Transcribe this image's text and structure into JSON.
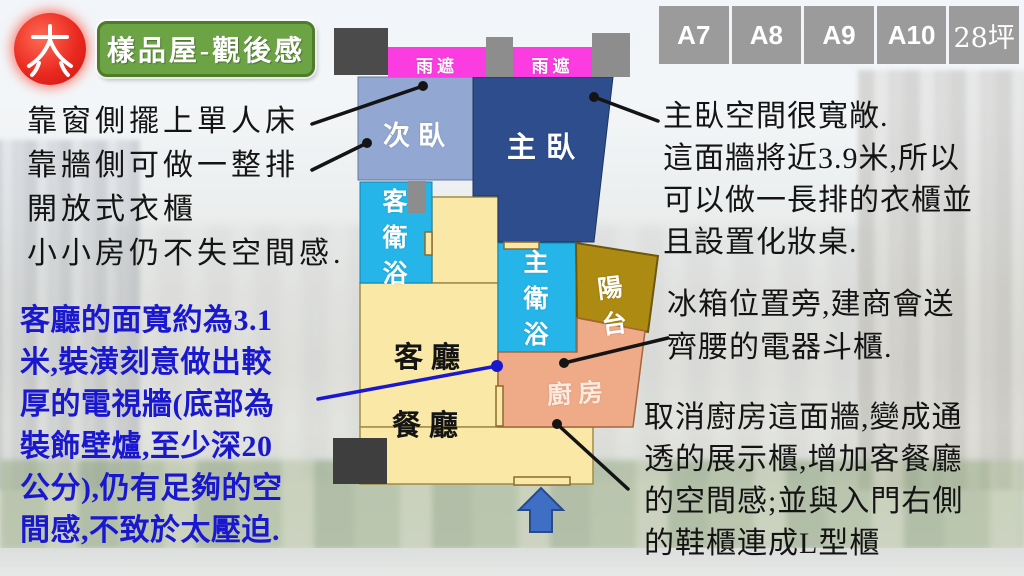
{
  "title_badge": {
    "text": "樣品屋-觀後感"
  },
  "unit_tabs": [
    "A7",
    "A8",
    "A9",
    "A10",
    "28坪"
  ],
  "floor_plan": {
    "labels": {
      "rain_cover_left": "雨遮",
      "rain_cover_right": "雨遮",
      "secondary_bedroom": "次臥",
      "master_bedroom": "主臥",
      "guest_bathroom": "客衛浴",
      "master_bathroom": "主衛浴",
      "balcony": "陽台",
      "kitchen": "廚房",
      "living_room": "客廳",
      "dining_room": "餐廳"
    },
    "entrance_arrow_direction": "up"
  },
  "annotations": {
    "secondary_bedroom_notes": [
      "靠窗側擺上單人床",
      "靠牆側可做一整排",
      "開放式衣櫃",
      "小小房仍不失空間感."
    ],
    "living_room_note": [
      "客廳的面寬約為3.1",
      "米,裝潢刻意做出較",
      "厚的電視牆(底部為",
      "裝飾壁爐,至少深20",
      "公分),仍有足夠的空",
      "間感,不致於太壓迫."
    ],
    "master_bedroom_note": [
      "主臥空間很寬敞.",
      "這面牆將近3.9米,所以",
      "可以做一長排的衣櫃並",
      "且設置化妝桌."
    ],
    "kitchen_cabinet_note": [
      "冰箱位置旁,建商會送",
      "齊腰的電器斗櫃."
    ],
    "kitchen_wall_note": [
      "取消廚房這面牆,變成通",
      "透的展示櫃,增加客餐廳",
      "的空間感;並與入門右側",
      "的鞋櫃連成L型櫃"
    ]
  },
  "colors": {
    "title_green": "#6ca445",
    "rain_cover_magenta": "#fb3ce0",
    "secondary_bedroom_blue": "#92a8d2",
    "master_bedroom_blue": "#2d4d8d",
    "bathroom_cyan": "#25b5e8",
    "balcony_gold": "#ad8a11",
    "kitchen_peach": "#efaa87",
    "living_cream": "#fae8a6",
    "annotation_blue": "#1a18cf",
    "tab_gray": "#9b9b9b",
    "arrow_blue": "#3f6ec5"
  }
}
